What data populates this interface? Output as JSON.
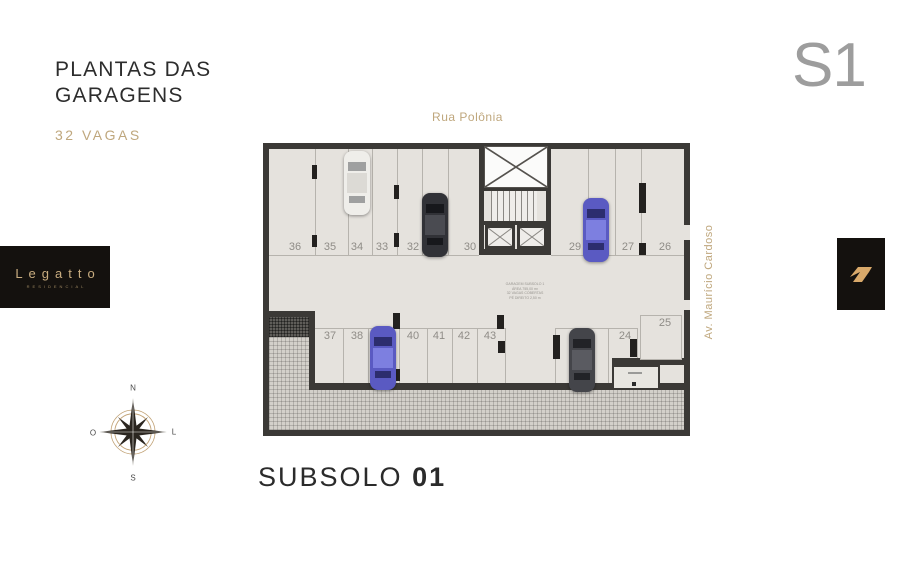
{
  "header": {
    "title_line1": "PLANTAS DAS",
    "title_line2": "GARAGENS",
    "subtitle": "32 VAGAS",
    "level_label": "S1"
  },
  "branding": {
    "name": "Legatto",
    "sub": "RESIDENCIAL"
  },
  "compass": {
    "n": "N",
    "s": "S",
    "w": "O",
    "e": "L"
  },
  "plan": {
    "street_top": "Rua Polônia",
    "street_right": "Av. Maurício Cardoso",
    "note_lines": [
      "GARAGEM SUBSOLO 1",
      "ÁREA 755,00 m²",
      "32 VAGAS COBERTAS",
      "PÉ DIREITO 2,50 m"
    ],
    "stalls": {
      "top_left": [
        "36",
        "35",
        "34",
        "33",
        "32",
        "31",
        "30"
      ],
      "top_right": [
        "29",
        "28",
        "27",
        "26"
      ],
      "bottom_left": [
        "37",
        "38",
        "39",
        "40",
        "41",
        "42",
        "43"
      ],
      "bottom_right": [
        "23",
        "24"
      ],
      "isolated": [
        "25"
      ]
    },
    "caption_light": "SUBSOLO",
    "caption_bold": "01"
  },
  "colors": {
    "accent_gold": "#BFA77D",
    "logo_gold": "#C9AD80",
    "wall": "#3B3936",
    "floor": "#E5E2DD",
    "level_gray": "#9D9D9D",
    "car_white": "#EFEEEA",
    "car_black": "#313237",
    "car_blue": "#5A5AC2",
    "car_dark": "#44454A"
  }
}
